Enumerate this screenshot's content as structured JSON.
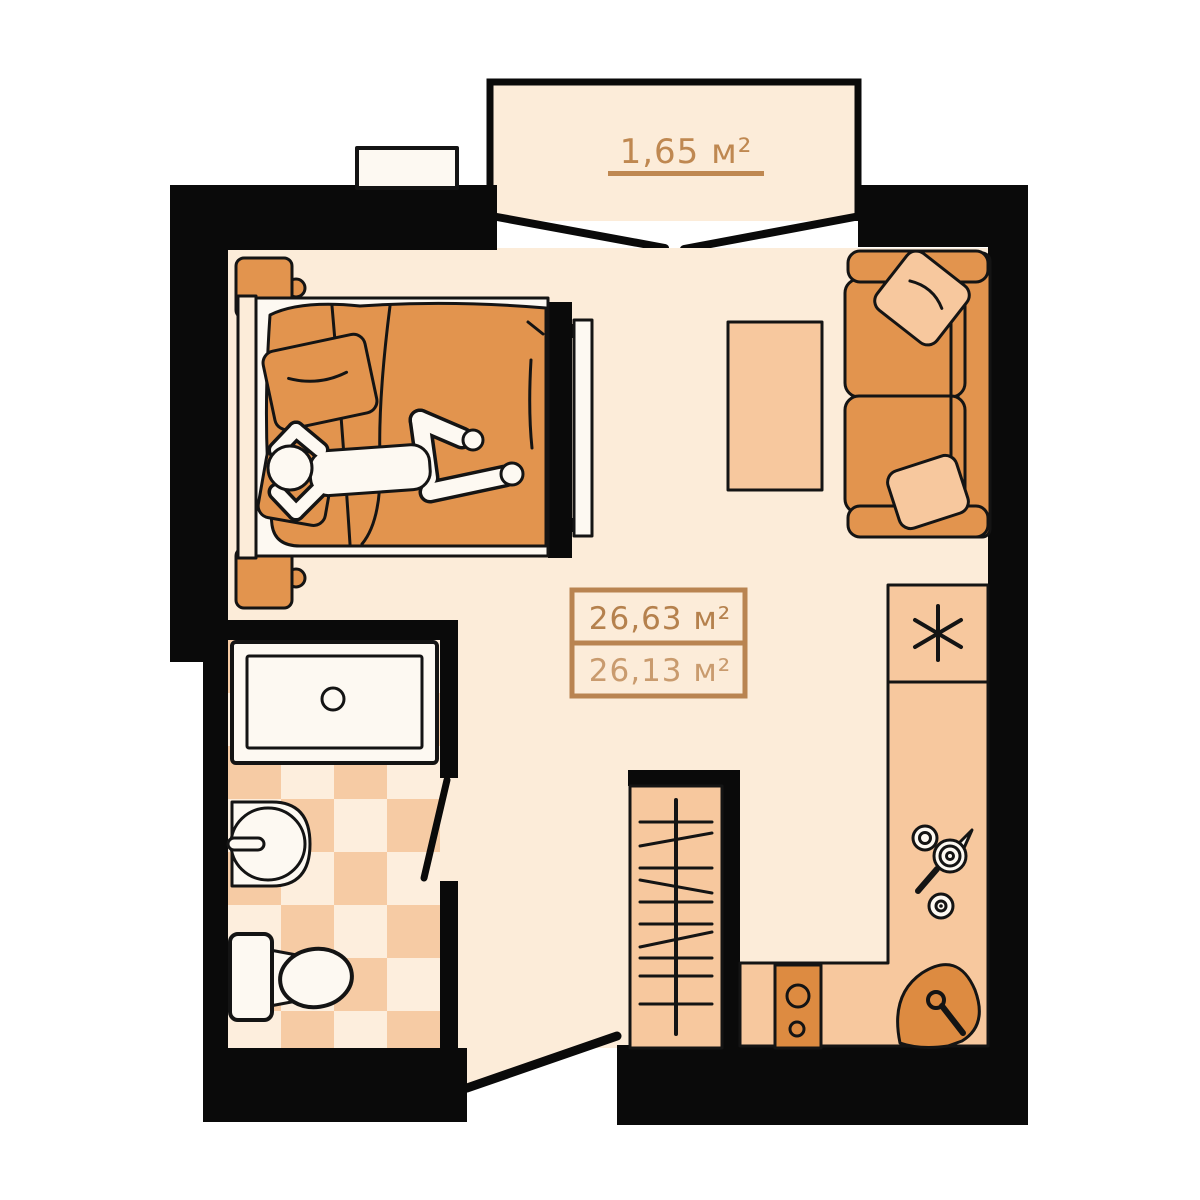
{
  "plan": {
    "type": "studio-apartment-floor-plan",
    "balcony": {
      "area_label": "1,65 м²"
    },
    "area_box": {
      "total_area": "26,63 м²",
      "living_area": "26,13 м²"
    },
    "furniture_visible": [
      "balcony",
      "double-bed",
      "person-lying",
      "nightstand",
      "nightstand",
      "tv",
      "sofa",
      "sofa-pillows",
      "coffee-table",
      "wardrobe-with-hangers",
      "fridge",
      "kitchen-counter",
      "cooking-pots",
      "stove-two-burners",
      "corner-kitchen-sink",
      "bathtub",
      "wash-basin",
      "toilet",
      "checkered-bathroom-floor",
      "entrance-door",
      "bathroom-door",
      "balcony-doors",
      "ventilation-shaft"
    ]
  },
  "palette": {
    "background": "#ffffff",
    "wall": "#0a0a0a",
    "outline": "#141414",
    "floor": "#fcecd9",
    "orange": "#e2944e",
    "peach": "#f7c89e",
    "darkOrange": "#dd8b41",
    "fixture": "#fdf9f2",
    "tilePeach": "#f6cba4",
    "tileCream": "#fdeedd",
    "labelBrown": "#bf8851",
    "areaTotalColor": "#b5814d",
    "areaLivingColor": "#c99b6e",
    "boxBorder": "#b98451"
  }
}
